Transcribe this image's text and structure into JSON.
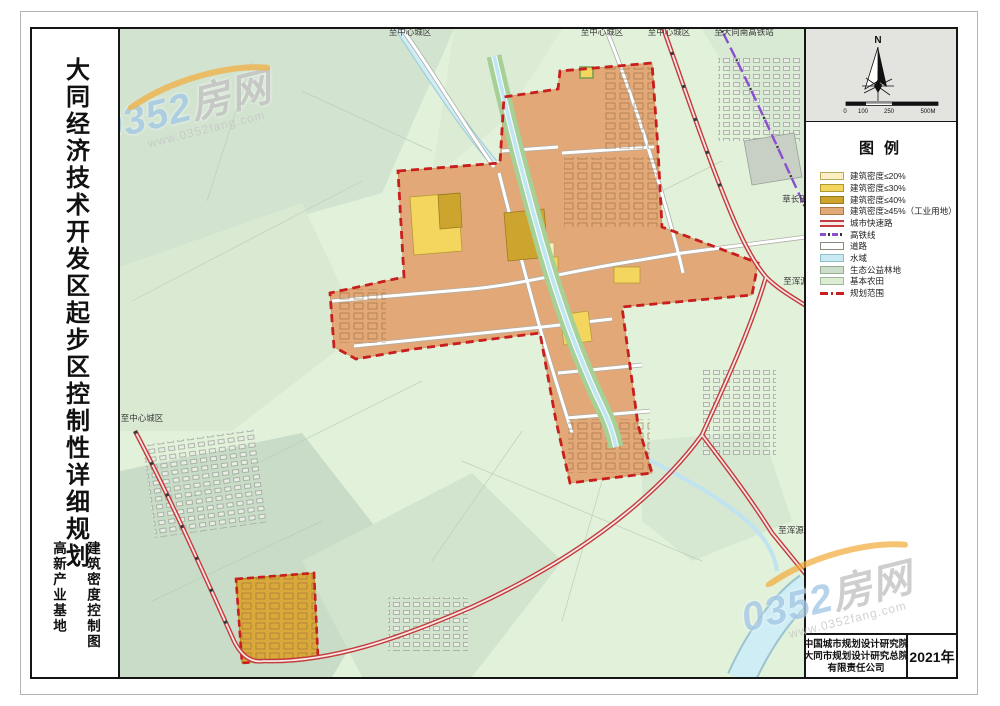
{
  "title": {
    "main": "大同经济技术开发区起步区控制性详细规划",
    "sub_left": "高新产业基地",
    "sub_right": "建筑密度控制图"
  },
  "compass": {
    "north_label": "N",
    "scale_labels": [
      "0",
      "100",
      "250",
      "500M"
    ]
  },
  "legend": {
    "title": "图例",
    "items": [
      {
        "label": "建筑密度≤20%",
        "type": "area",
        "color": "#FBF0C4",
        "border": "#B8A860"
      },
      {
        "label": "建筑密度≤30%",
        "type": "area",
        "color": "#F4D55E",
        "border": "#B09830"
      },
      {
        "label": "建筑密度≤40%",
        "type": "area",
        "color": "#CDA52E",
        "border": "#96781E"
      },
      {
        "label": "建筑密度≥45%（工业用地）",
        "type": "area",
        "color": "#E2A877",
        "border": "#B07840"
      },
      {
        "label": "城市快速路",
        "type": "road-red",
        "color": "#C43B3B"
      },
      {
        "label": "高铁线",
        "type": "rail",
        "color": "#8A4FD0"
      },
      {
        "label": "道路",
        "type": "road",
        "color": "#FFFFFF"
      },
      {
        "label": "水域",
        "type": "area",
        "color": "#C9EAF2",
        "border": "#8FBECC"
      },
      {
        "label": "生态公益林地",
        "type": "area",
        "color": "#CBDFCB",
        "border": "#93AE93"
      },
      {
        "label": "基本农田",
        "type": "area",
        "color": "#DCEDD4",
        "border": "#9FB898"
      },
      {
        "label": "规划范围",
        "type": "boundary",
        "color": "#C81E1E"
      }
    ]
  },
  "map": {
    "labels": [
      {
        "text": "至中心城区",
        "x": 408,
        "y": 34
      },
      {
        "text": "至中心城区",
        "x": 600,
        "y": 34
      },
      {
        "text": "至中心城区",
        "x": 667,
        "y": 34
      },
      {
        "text": "至大同南高铁站",
        "x": 742,
        "y": 34
      },
      {
        "text": "至中心城区",
        "x": 140,
        "y": 420
      },
      {
        "text": "草长田",
        "x": 793,
        "y": 201
      },
      {
        "text": "至浑源",
        "x": 794,
        "y": 283
      },
      {
        "text": "至浑源",
        "x": 789,
        "y": 532
      }
    ]
  },
  "attribution": {
    "lines": [
      "中国城市规划设计研究院",
      "大同市规划设计研究总院",
      "有限责任公司"
    ],
    "year": "2021年"
  },
  "watermark": {
    "brand_blue": "0352",
    "brand_gray": "房网",
    "url": "www.0352fang.com"
  },
  "colors": {
    "farmland": "#E2F1DA",
    "eco_forest": "#CFE2CE",
    "water": "#C9EAF2",
    "green_corridor": "#A6D095",
    "industrial": "#E2A877",
    "expressway": "#C43B3B",
    "rail": "#8A4FD0",
    "boundary": "#C81E1E"
  }
}
